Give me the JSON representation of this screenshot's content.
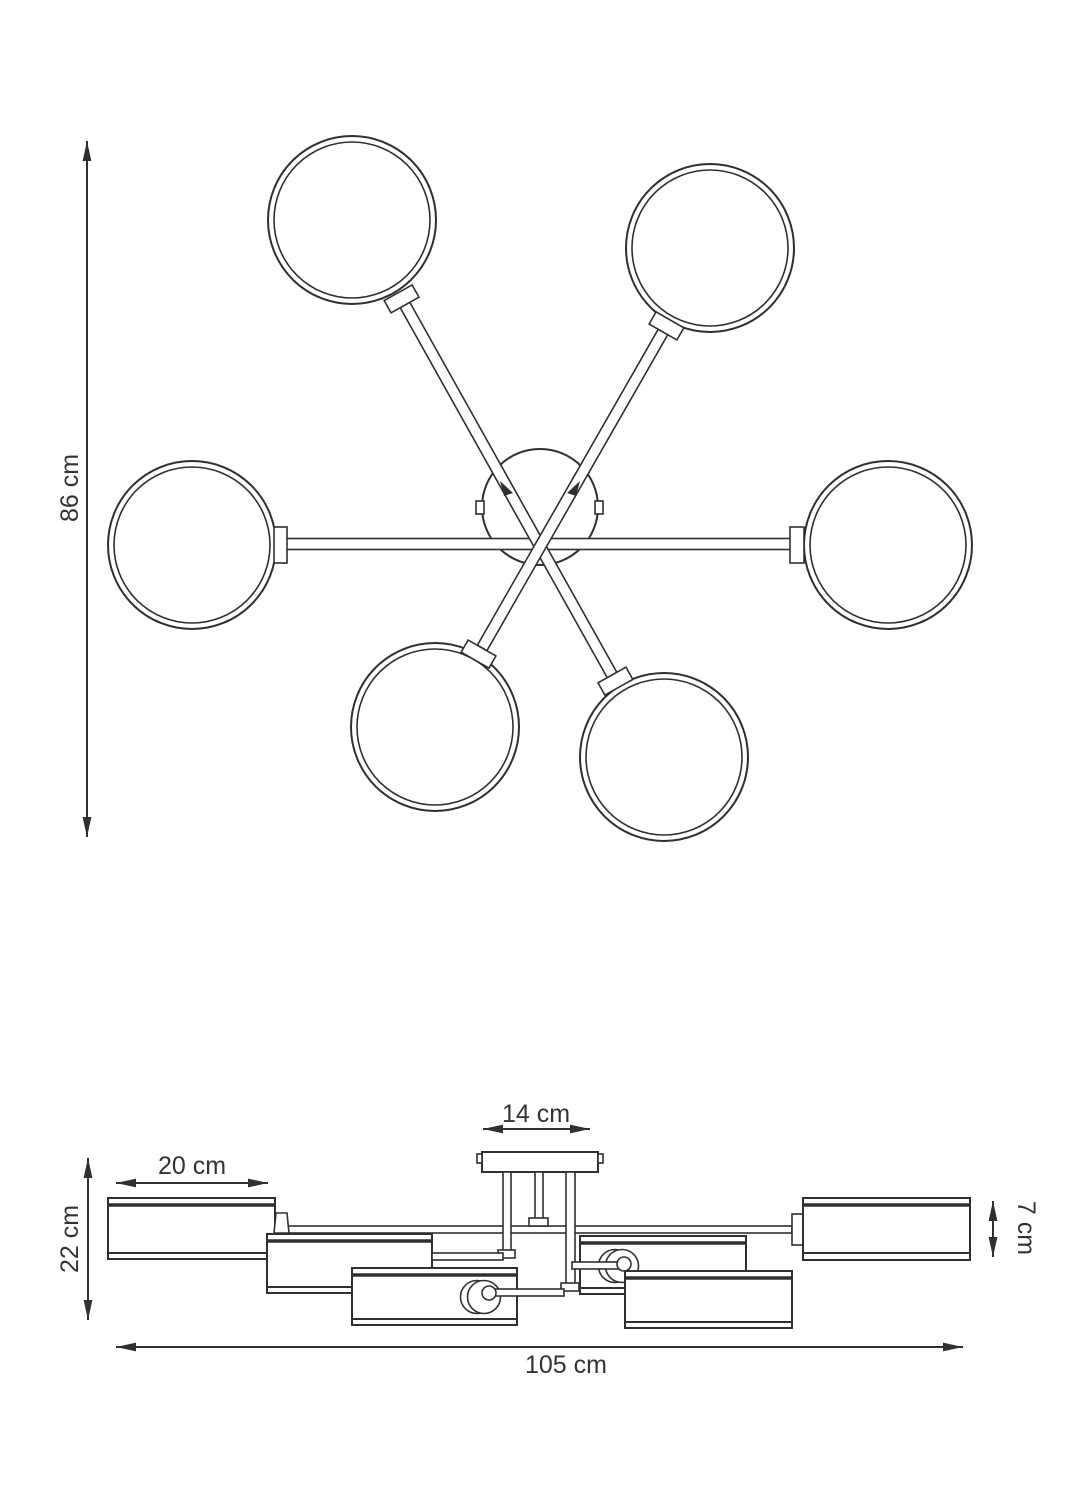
{
  "diagram": {
    "subject": "6-light ceiling lamp technical dimension drawing, top view and side view",
    "colors": {
      "line": "#303030",
      "text": "#333333",
      "background": "#ffffff"
    },
    "top_view": {
      "globe_count": 6,
      "labels": {
        "height": "86 cm"
      }
    },
    "side_view": {
      "labels": {
        "canopy_width": "14 cm",
        "shade_width": "20 cm",
        "fixture_height": "22 cm",
        "shade_height": "7 cm",
        "total_width": "105 cm"
      }
    }
  }
}
